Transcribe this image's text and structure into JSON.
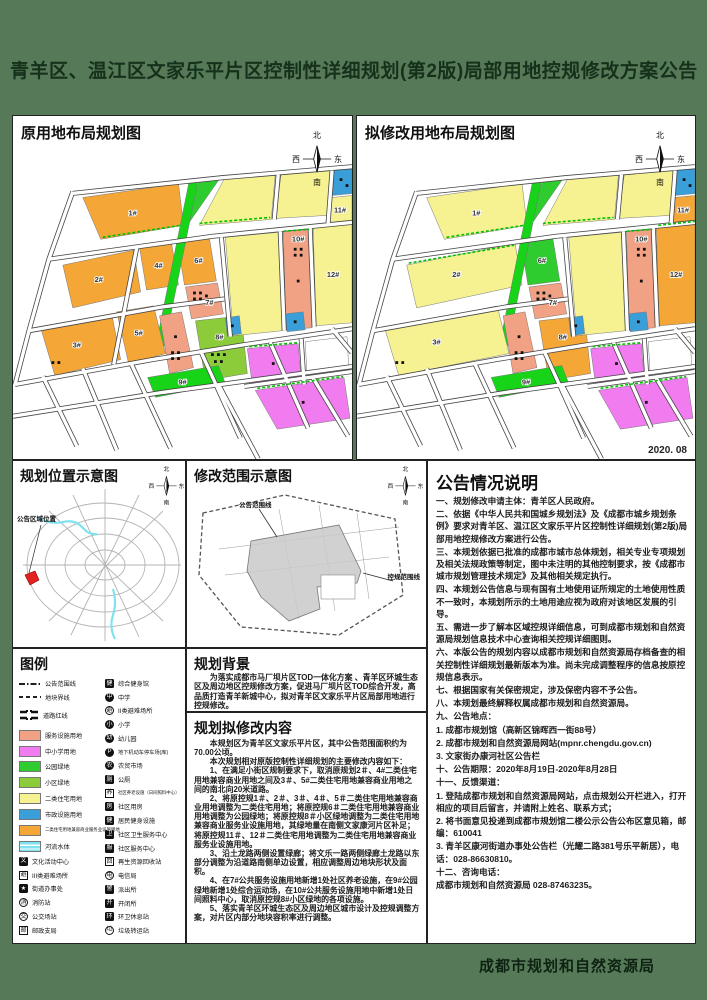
{
  "title": "青羊区、温江区文家乐平片区控制性详细规划(第2版)局部用地控规修改方案公告",
  "date": "2020. 08",
  "footer": {
    "agency": "成都市规划和自然资源局"
  },
  "compass": {
    "north": "北",
    "south": "南",
    "west": "西",
    "east": "东"
  },
  "panels": {
    "left_map_title": "原用地布局规划图",
    "right_map_title": "拟修改用地布局规划图",
    "location_title": "规划位置示意图",
    "scope_title": "修改范围示意图",
    "legend_title": "图例",
    "background_title": "规划背景",
    "content_title": "规划拟修改内容",
    "notes_title": "公告情况说明"
  },
  "location_map": {
    "marker_label": "公告区域位置"
  },
  "scope_map": {
    "inner_label": "公告范围线",
    "outer_label": "控规范围线"
  },
  "background_text": "为落实成都市马厂坝片区TOD一体化方案 、青羊区环城生态区及周边地区控规修改方案，促进马厂坝片区TOD综合开发，高品质打造青羊新城中心，拟对青羊区文家乐平片区局部用地进行控规修改。",
  "content_paragraphs": [
    "本规划区为青羊区文家乐平片区，其中公告范围面积约为70.00公顷。",
    "本次规划相对原版控制性详细规划的主要修改内容如下：",
    "1、在满足小街区规制要求下，取消原规划2＃、4#二类住宅用地兼容商业用地之间及3＃、5#二类住宅用地兼容商业用地之间的南北向20米道路。",
    "2、将原控规1＃、2＃、3＃、4＃、5＃二类住宅用地兼容商业用地调整为二类住宅用地；将原控规6＃二类住宅用地兼容商业用地调整为公园绿地；将原控规8＃小区绿地调整为二类住宅用地兼容商业服务业设施用地，其绿地量在南侧文家康河片区补足；将原控规11＃、12＃二类住宅用地调整为二类住宅用地兼容商业服务业设施用地。",
    "3、沿土龙路两侧设置绿廊；将文乐一路两侧绿廊土龙路以东部分调整为沿道路南侧单边设置，相应调整周边地块形状及面积。",
    "4、在7#公共服务设施用地新增1处社区养老设施，在9#公园绿地新增1处综合运动场，在10#公共服务设施用地中新增1处日间照料中心，取消原控规8#小区绿地的各项设施。",
    "5、落实青羊区环城生态区及周边地区城市设计及控规调整方案，对片区内部分地块容积率进行调整。"
  ],
  "notes_paragraphs": [
    "一、规划修改申请主体：青羊区人民政府。",
    "二、依据《中华人民共和国城乡规划法》及《成都市城乡规划条例》要求对青羊区、温江区文家乐平片区控制性详细规划(第2版)局部用地控规修改方案进行公告。",
    "三、本规划依据已批准的成都市城市总体规划，相关专业专项规划及相关法规政策等制定，图中未注明的其他控制要求，按《成都市城市规划管理技术规定》及其他相关规定执行。",
    "四、本规划公告信息与现有国有土地使用证所规定的土地使用性质不一致时，本规划所示的土地用途应视为政府对该地区发展的引导。",
    "五、需进一步了解本区域控规详细信息，可到成都市规划和自然资源局规划信息技术中心查询相关控规详细图则。",
    "六、本版公告的规划内容以成都市规划和自然资源局存档备查的相关控制性详细规划最新版本为准。尚未完成调整程序的信息按原控规信息表示。",
    "七、根据国家有关保密规定，涉及保密内容不予公告。",
    "八、本规划最终解释权属成都市规划和自然资源局。",
    "九、公告地点：",
    "1. 成都市规划馆（高新区锦晖西一街88号）",
    "2. 成都市规划和自然资源局网站(mpnr.chengdu.gov.cn)",
    "3. 文家街办康河社区公告栏",
    "十、公告期限：2020年8月19日-2020年8月28日",
    "十一、反馈渠道：",
    "1. 登陆成都市规划和自然资源局网站，点击规划公开栏进入，打开相应的项目后留言，并请附上姓名、联系方式；",
    "2. 将书面意见投递到成都市规划馆二楼公示公告公布区意见箱，邮编：610041",
    "3. 青羊区康河街道办事处公告栏（光耀二路381号乐平新居），电话：028-86630810。",
    "十二、咨询电话：",
    "成都市规划和自然资源局 028-87463235。"
  ],
  "colors": {
    "orange": "#F4A636",
    "yellow": "#F6F292",
    "salmon": "#F2A284",
    "magenta": "#F07CF0",
    "parkgreen": "#2ECC2E",
    "nbhdgreen": "#8CCB3A",
    "stripgreen": "#18D418",
    "blue": "#3A9FD8",
    "water": "#7FE3EF",
    "white": "#FFFFFF",
    "poster_green": "#567A58",
    "title_text": "#16311B",
    "green_dashed_line": "#00C000"
  },
  "legend": {
    "col1": [
      {
        "sym": "line-dashdot",
        "label": "公告范围线",
        "name": "announcement-boundary-line"
      },
      {
        "sym": "line-dashed",
        "label": "地块界线",
        "name": "parcel-boundary-line"
      },
      {
        "sym": "road",
        "label": "道路红线",
        "name": "road-red-line"
      },
      {
        "sym": "swatch",
        "color": "salmon",
        "label": "服务设施用地",
        "name": "service-facility-land"
      },
      {
        "sym": "swatch",
        "color": "magenta",
        "label": "中小学用地",
        "name": "school-land"
      },
      {
        "sym": "swatch",
        "color": "parkgreen",
        "label": "公园绿地",
        "name": "park-green-land"
      },
      {
        "sym": "swatch",
        "color": "nbhdgreen",
        "label": "小区绿地",
        "name": "neighborhood-green-land"
      },
      {
        "sym": "swatch",
        "color": "yellow",
        "label": "二类住宅用地",
        "name": "class2-residential-land"
      },
      {
        "sym": "swatch",
        "color": "blue",
        "label": "市政设施用地",
        "name": "municipal-facility-land"
      },
      {
        "sym": "swatch",
        "color": "orange",
        "label": "二类住宅用地兼容商业服务业设施用地",
        "name": "residential-commercial-mixed-land"
      },
      {
        "sym": "water",
        "color": "water",
        "label": "河流水体",
        "name": "river-water"
      },
      {
        "sym": "icon",
        "glyph": "文",
        "style": "black-square",
        "label": "文化活动中心",
        "name": "culture-center-icon"
      },
      {
        "sym": "icon",
        "glyph": "避",
        "style": "outline-square",
        "label": "III类避难场所",
        "name": "class3-shelter-icon"
      },
      {
        "sym": "icon",
        "glyph": "★",
        "style": "black-square",
        "label": "街道办事处",
        "name": "street-office-icon"
      },
      {
        "sym": "icon",
        "glyph": "消",
        "style": "outline-circle",
        "label": "消防站",
        "name": "fire-station-icon"
      },
      {
        "sym": "icon",
        "glyph": "交",
        "style": "outline-circle",
        "label": "公交场站",
        "name": "bus-depot-icon"
      },
      {
        "sym": "icon",
        "glyph": "邮",
        "style": "outline-square",
        "label": "邮政支局",
        "name": "post-office-icon"
      }
    ],
    "col2": [
      {
        "sym": "icon",
        "glyph": "健",
        "style": "black-square",
        "label": "综合健身馆",
        "name": "gym-icon"
      },
      {
        "sym": "icon",
        "glyph": "中",
        "style": "black-circle",
        "label": "中学",
        "name": "middle-school-icon"
      },
      {
        "sym": "icon",
        "glyph": "避",
        "style": "outline-circle",
        "label": "II类避难场所",
        "name": "class2-shelter-icon"
      },
      {
        "sym": "icon",
        "glyph": "小",
        "style": "black-circle",
        "label": "小学",
        "name": "primary-school-icon"
      },
      {
        "sym": "icon",
        "glyph": "幼",
        "style": "black-circle",
        "label": "幼儿园",
        "name": "kindergarten-icon"
      },
      {
        "sym": "icon",
        "glyph": "P",
        "style": "black-circle",
        "label": "地下机动车停车场(库)",
        "name": "underground-parking-icon"
      },
      {
        "sym": "icon",
        "glyph": "农",
        "style": "black-circle",
        "label": "农贸市场",
        "name": "farmers-market-icon"
      },
      {
        "sym": "icon",
        "glyph": "厕",
        "style": "black-square",
        "label": "公厕",
        "name": "public-toilet-icon"
      },
      {
        "sym": "icon",
        "glyph": "养",
        "style": "outline-square",
        "label": "社区养老设施（日间照料中心）",
        "name": "elderly-care-icon"
      },
      {
        "sym": "icon",
        "glyph": "房",
        "style": "black-square",
        "label": "社区用房",
        "name": "community-housing-icon"
      },
      {
        "sym": "icon",
        "glyph": "健",
        "style": "black-square",
        "label": "居民健身设施",
        "name": "resident-fitness-icon"
      },
      {
        "sym": "icon",
        "glyph": "卫",
        "style": "black-square",
        "label": "社区卫生服务中心",
        "name": "community-health-center-icon"
      },
      {
        "sym": "icon",
        "glyph": "服",
        "style": "black-square",
        "label": "社区服务中心",
        "name": "community-service-center-icon"
      },
      {
        "sym": "icon",
        "glyph": "回",
        "style": "outline-square",
        "label": "再生资源回收站",
        "name": "recycling-station-icon"
      },
      {
        "sym": "icon",
        "glyph": "电",
        "style": "outline-circle",
        "label": "电信局",
        "name": "telecom-office-icon"
      },
      {
        "sym": "icon",
        "glyph": "警",
        "style": "black-square",
        "label": "派出所",
        "name": "police-station-icon"
      },
      {
        "sym": "icon",
        "glyph": "开",
        "style": "black-square",
        "label": "开闭所",
        "name": "switching-station-icon"
      },
      {
        "sym": "icon",
        "glyph": "环",
        "style": "black-square",
        "label": "环卫休息站",
        "name": "sanitation-rest-icon"
      },
      {
        "sym": "icon",
        "glyph": "垃",
        "style": "outline-circle",
        "label": "垃圾转运站",
        "name": "garbage-transfer-icon"
      }
    ]
  },
  "maps": {
    "left": {
      "parcels": [
        {
          "pts": "70,82 166,68 171,110 88,124",
          "fill": "orange",
          "label": "1#",
          "lx": 120,
          "ly": 100
        },
        {
          "pts": "188,63 208,62 174,111 169,107",
          "fill": "parkgreen"
        },
        {
          "pts": "212,63 263,59 259,104 187,110",
          "fill": "yellow"
        },
        {
          "pts": "269,58 318,55 315,100 263,103",
          "fill": "yellow"
        },
        {
          "pts": "322,54 340,52 340,78 319,80",
          "fill": "blue",
          "dots": [
            [
              329,
              64
            ],
            [
              335,
              70
            ]
          ]
        },
        {
          "pts": "319,82 340,80 340,106 316,108",
          "fill": "yellow",
          "label": "11#",
          "lx": 328,
          "ly": 97
        },
        {
          "pts": "50,150 121,135 128,177 60,193",
          "fill": "orange",
          "label": "2#",
          "lx": 86,
          "ly": 167
        },
        {
          "pts": "127,133 159,128 166,170 134,175",
          "fill": "orange",
          "label": "4#",
          "lx": 146,
          "ly": 153
        },
        {
          "pts": "165,127 197,123 204,166 172,170",
          "fill": "orange",
          "label": "6#",
          "lx": 186,
          "ly": 148
        },
        {
          "pts": "177,64 186,63 152,231 143,232",
          "fill": "stripgreen"
        },
        {
          "pts": "173,172 205,168 211,199 179,204",
          "fill": "salmon",
          "label": "7#",
          "lx": 197,
          "ly": 190,
          "dots": [
            [
              182,
              178
            ],
            [
              188,
              178
            ],
            [
              182,
              184
            ],
            [
              188,
              184
            ],
            [
              194,
              181
            ]
          ]
        },
        {
          "pts": "28,214 99,199 108,245 42,261",
          "fill": "orange",
          "label": "3#",
          "lx": 64,
          "ly": 233,
          "dots": [
            [
              40,
              248
            ],
            [
              46,
              248
            ]
          ]
        },
        {
          "pts": "104,197 141,191 153,239 116,249",
          "fill": "orange",
          "label": "5#",
          "lx": 126,
          "ly": 221
        },
        {
          "pts": "147,201 169,197 181,253 157,259",
          "fill": "salmon",
          "dots": [
            [
              160,
              238
            ],
            [
              166,
              238
            ],
            [
              160,
              244
            ],
            [
              166,
              244
            ],
            [
              163,
              222
            ]
          ]
        },
        {
          "pts": "183,206 229,201 235,259 193,266",
          "fill": "nbhdgreen",
          "label": "8#",
          "lx": 207,
          "ly": 225,
          "dots": [
            [
              200,
              240
            ],
            [
              206,
              240
            ],
            [
              212,
              240
            ],
            [
              203,
              247
            ],
            [
              209,
              247
            ]
          ]
        },
        {
          "pts": "135,263 206,251 213,269 143,283",
          "fill": "stripgreen",
          "label": "9#",
          "lx": 170,
          "ly": 270
        },
        {
          "pts": "213,122 266,117 270,216 221,221",
          "fill": "yellow"
        },
        {
          "pts": "213,203 227,201 229,219 215,221",
          "fill": "blue",
          "dots": [
            [
              220,
              211
            ]
          ]
        },
        {
          "pts": "271,116 297,114 300,213 274,215",
          "fill": "salmon",
          "label": "10#",
          "lx": 286,
          "ly": 126,
          "dots": [
            [
              283,
              134
            ],
            [
              289,
              134
            ],
            [
              283,
              140
            ],
            [
              289,
              140
            ],
            [
              286,
              166
            ]
          ]
        },
        {
          "pts": "273,199 291,197 293,215 275,217",
          "fill": "blue",
          "dots": [
            [
              283,
              207
            ]
          ]
        },
        {
          "pts": "301,112 340,108 340,208 304,211",
          "fill": "yellow",
          "label": "12#",
          "lx": 321,
          "ly": 162
        },
        {
          "pts": "235,234 286,229 289,266 240,270",
          "fill": "magenta",
          "dots": [
            [
              261,
              249
            ]
          ]
        },
        {
          "pts": "293,227 335,222 337,258 295,261",
          "fill": "white"
        },
        {
          "pts": "243,276 332,263 338,304 265,315",
          "fill": "magenta",
          "dots": [
            [
              291,
              288
            ]
          ]
        }
      ],
      "roads": [
        "M58,78 L210,62 L340,51",
        "M36,144 L200,121 L340,107",
        "M16,216 L150,192 L212,184",
        "M2,270 L140,245 L232,230 L340,214",
        "M60,76 L36,144 L16,216 L2,270",
        "M124,133 L101,250",
        "M209,122 L218,222",
        "M268,116 L272,216",
        "M298,112 L302,212",
        "M266,59 L262,104",
        "M320,55 L316,108",
        "M232,272 L340,257",
        "M289,224 L292,270",
        "M0,302 L150,278 L340,252",
        "M30,262 L64,332",
        "M70,254 L104,336",
        "M118,248 L158,334",
        "M188,236 L228,324",
        "M258,228 L296,314",
        "M206,270 L246,345",
        "M300,262 L336,322",
        "M320,214 L340,238"
      ],
      "green_edges": [
        "M90,122 L168,110",
        "M187,108 L258,102",
        "M271,116 L297,114",
        "M237,232 L286,228",
        "M245,274 L331,262"
      ]
    },
    "right": {
      "parcels": [
        {
          "pts": "70,82 166,68 171,110 88,124",
          "fill": "yellow",
          "label": "1#",
          "lx": 120,
          "ly": 100
        },
        {
          "pts": "188,63 208,62 174,111 169,107",
          "fill": "parkgreen"
        },
        {
          "pts": "212,63 263,59 259,104 187,110",
          "fill": "yellow"
        },
        {
          "pts": "269,58 318,55 315,100 263,103",
          "fill": "yellow"
        },
        {
          "pts": "322,54 340,52 340,78 319,80",
          "fill": "blue",
          "dots": [
            [
              329,
              64
            ],
            [
              335,
              70
            ]
          ]
        },
        {
          "pts": "319,82 340,80 340,106 316,108",
          "fill": "orange",
          "label": "11#",
          "lx": 328,
          "ly": 97
        },
        {
          "pts": "50,150 159,128 166,170 60,193",
          "fill": "yellow",
          "label": "2#",
          "lx": 100,
          "ly": 162
        },
        {
          "pts": "165,127 197,123 204,166 172,170",
          "fill": "parkgreen",
          "label": "6#",
          "lx": 186,
          "ly": 148
        },
        {
          "pts": "177,64 186,63 152,231 143,232",
          "fill": "stripgreen"
        },
        {
          "pts": "173,172 205,168 211,199 179,204",
          "fill": "salmon",
          "label": "7#",
          "lx": 197,
          "ly": 190,
          "dots": [
            [
              182,
              178
            ],
            [
              188,
              178
            ],
            [
              182,
              184
            ],
            [
              188,
              184
            ],
            [
              194,
              181
            ]
          ]
        },
        {
          "pts": "28,214 141,191 153,239 42,261",
          "fill": "yellow",
          "label": "3#",
          "lx": 80,
          "ly": 230,
          "dots": [
            [
              40,
              248
            ],
            [
              46,
              248
            ]
          ]
        },
        {
          "pts": "147,201 169,197 181,253 157,259",
          "fill": "salmon",
          "dots": [
            [
              160,
              238
            ],
            [
              166,
              238
            ],
            [
              160,
              244
            ],
            [
              166,
              244
            ],
            [
              163,
              222
            ]
          ]
        },
        {
          "pts": "183,206 229,201 235,259 193,266",
          "fill": "orange",
          "label": "8#",
          "lx": 207,
          "ly": 225
        },
        {
          "pts": "135,263 206,251 213,269 143,283",
          "fill": "stripgreen",
          "label": "9#",
          "lx": 170,
          "ly": 270
        },
        {
          "pts": "213,122 266,117 270,216 221,221",
          "fill": "yellow"
        },
        {
          "pts": "213,203 227,201 229,219 215,221",
          "fill": "blue",
          "dots": [
            [
              220,
              211
            ]
          ]
        },
        {
          "pts": "271,116 297,114 300,213 274,215",
          "fill": "salmon",
          "label": "10#",
          "lx": 286,
          "ly": 126,
          "dots": [
            [
              283,
              134
            ],
            [
              289,
              134
            ],
            [
              283,
              140
            ],
            [
              289,
              140
            ],
            [
              286,
              166
            ]
          ]
        },
        {
          "pts": "273,199 291,197 293,215 275,217",
          "fill": "blue",
          "dots": [
            [
              283,
              207
            ]
          ]
        },
        {
          "pts": "301,112 340,108 340,208 304,211",
          "fill": "orange",
          "label": "12#",
          "lx": 321,
          "ly": 162
        },
        {
          "pts": "235,234 286,229 289,266 240,270",
          "fill": "magenta",
          "dots": [
            [
              261,
              249
            ]
          ]
        },
        {
          "pts": "293,227 335,222 337,258 295,261",
          "fill": "white"
        },
        {
          "pts": "243,276 332,263 338,304 265,315",
          "fill": "magenta",
          "dots": [
            [
              291,
              288
            ]
          ]
        }
      ],
      "roads": [
        "M58,78 L210,62 L340,51",
        "M36,144 L200,121 L340,107",
        "M16,216 L150,192 L212,184",
        "M2,270 L140,245 L232,230 L340,214",
        "M60,76 L36,144 L16,216 L2,270",
        "M209,122 L218,222",
        "M268,116 L272,216",
        "M298,112 L302,212",
        "M266,59 L262,104",
        "M320,55 L316,108",
        "M232,272 L340,257",
        "M289,224 L292,270",
        "M0,302 L150,278 L340,252",
        "M30,262 L64,332",
        "M70,254 L104,336",
        "M118,248 L158,334",
        "M188,236 L228,324",
        "M258,228 L296,314",
        "M206,270 L246,345",
        "M300,262 L336,322",
        "M320,214 L340,238"
      ],
      "green_edges": [
        "M90,122 L168,110",
        "M187,108 L258,102",
        "M271,116 L297,114",
        "M237,232 L286,228",
        "M245,274 L331,262",
        "M52,148 L158,130",
        "M303,110 L340,106"
      ]
    }
  }
}
